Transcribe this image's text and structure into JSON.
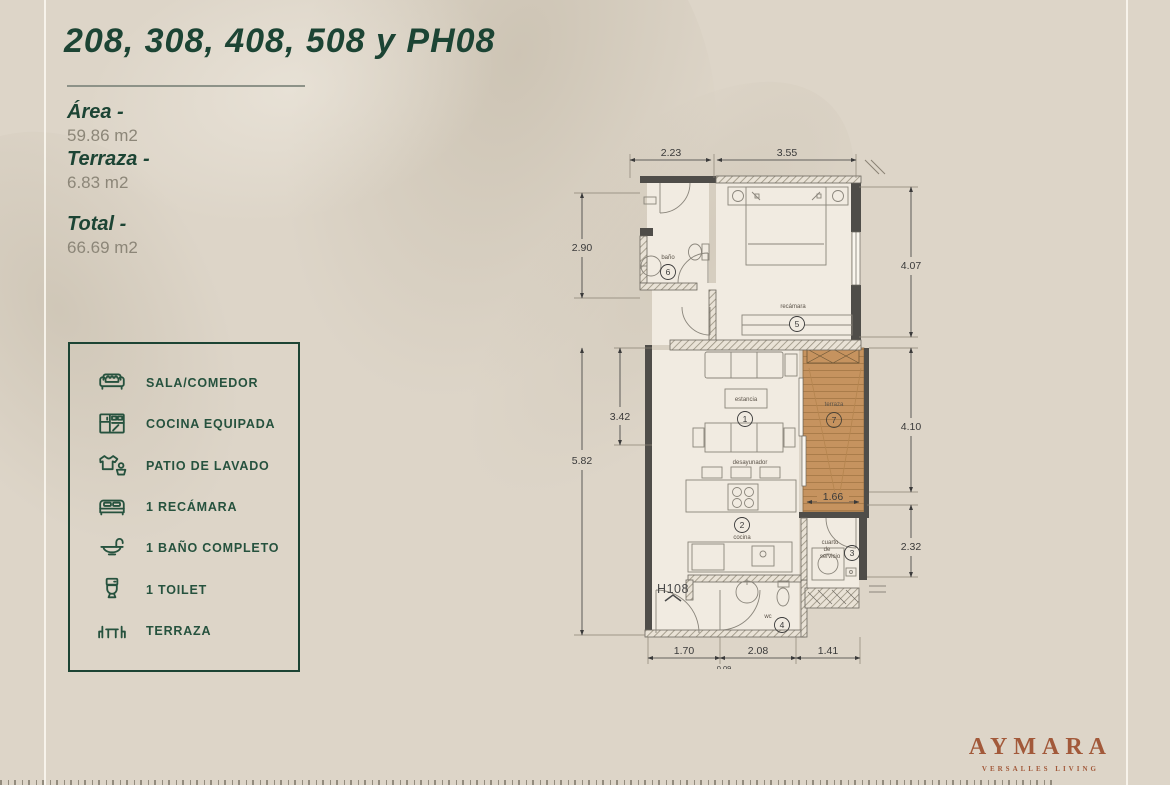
{
  "page": {
    "title": "208, 308, 408, 508 y PH08"
  },
  "stats": [
    {
      "label": "Área -",
      "value": "59.86 m2"
    },
    {
      "label": "Terraza -",
      "value": "6.83 m2"
    },
    {
      "label": "Total -",
      "value": "66.69 m2"
    }
  ],
  "legend": {
    "items": [
      {
        "icon": "sofa-icon",
        "label": "SALA/COMEDOR"
      },
      {
        "icon": "kitchen-icon",
        "label": "COCINA EQUIPADA"
      },
      {
        "icon": "laundry-icon",
        "label": "PATIO DE LAVADO"
      },
      {
        "icon": "bed-icon",
        "label": "1 RECÁMARA"
      },
      {
        "icon": "bath-icon",
        "label": "1 BAÑO COMPLETO"
      },
      {
        "icon": "toilet-icon",
        "label": "1 TOILET"
      },
      {
        "icon": "terrace-icon",
        "label": "TERRAZA"
      }
    ]
  },
  "floorplan": {
    "unit_label": "H108",
    "dimensions": {
      "top": [
        "2.23",
        "3.55"
      ],
      "left": [
        "2.90",
        "3.42",
        "5.82"
      ],
      "right": [
        "4.07",
        "4.10",
        "2.32"
      ],
      "bottom": [
        "1.70",
        "2.08",
        "1.41"
      ],
      "bottom_partial": "0.09",
      "terrace_width": "1.66"
    },
    "rooms": [
      {
        "number": "1",
        "name": "estancia"
      },
      {
        "number": "2",
        "name": "cocina"
      },
      {
        "number": "3",
        "name": "cuarto de servicio",
        "name_lines": [
          "cuarto",
          "de",
          "servicio"
        ]
      },
      {
        "number": "4",
        "name": "wc"
      },
      {
        "number": "5",
        "name": "recámara"
      },
      {
        "number": "6",
        "name": "baño"
      },
      {
        "number": "7",
        "name": "terraza"
      }
    ],
    "sublabel": "desayunador"
  },
  "brand": {
    "name": "AYMARA",
    "tagline": "VERSALLES LIVING"
  },
  "colors": {
    "background": "#ddd5c8",
    "accent_green": "#1c4434",
    "text_gray": "#8c8678",
    "terracotta": "#a2593a",
    "terrace_wood": "#c6935f"
  }
}
